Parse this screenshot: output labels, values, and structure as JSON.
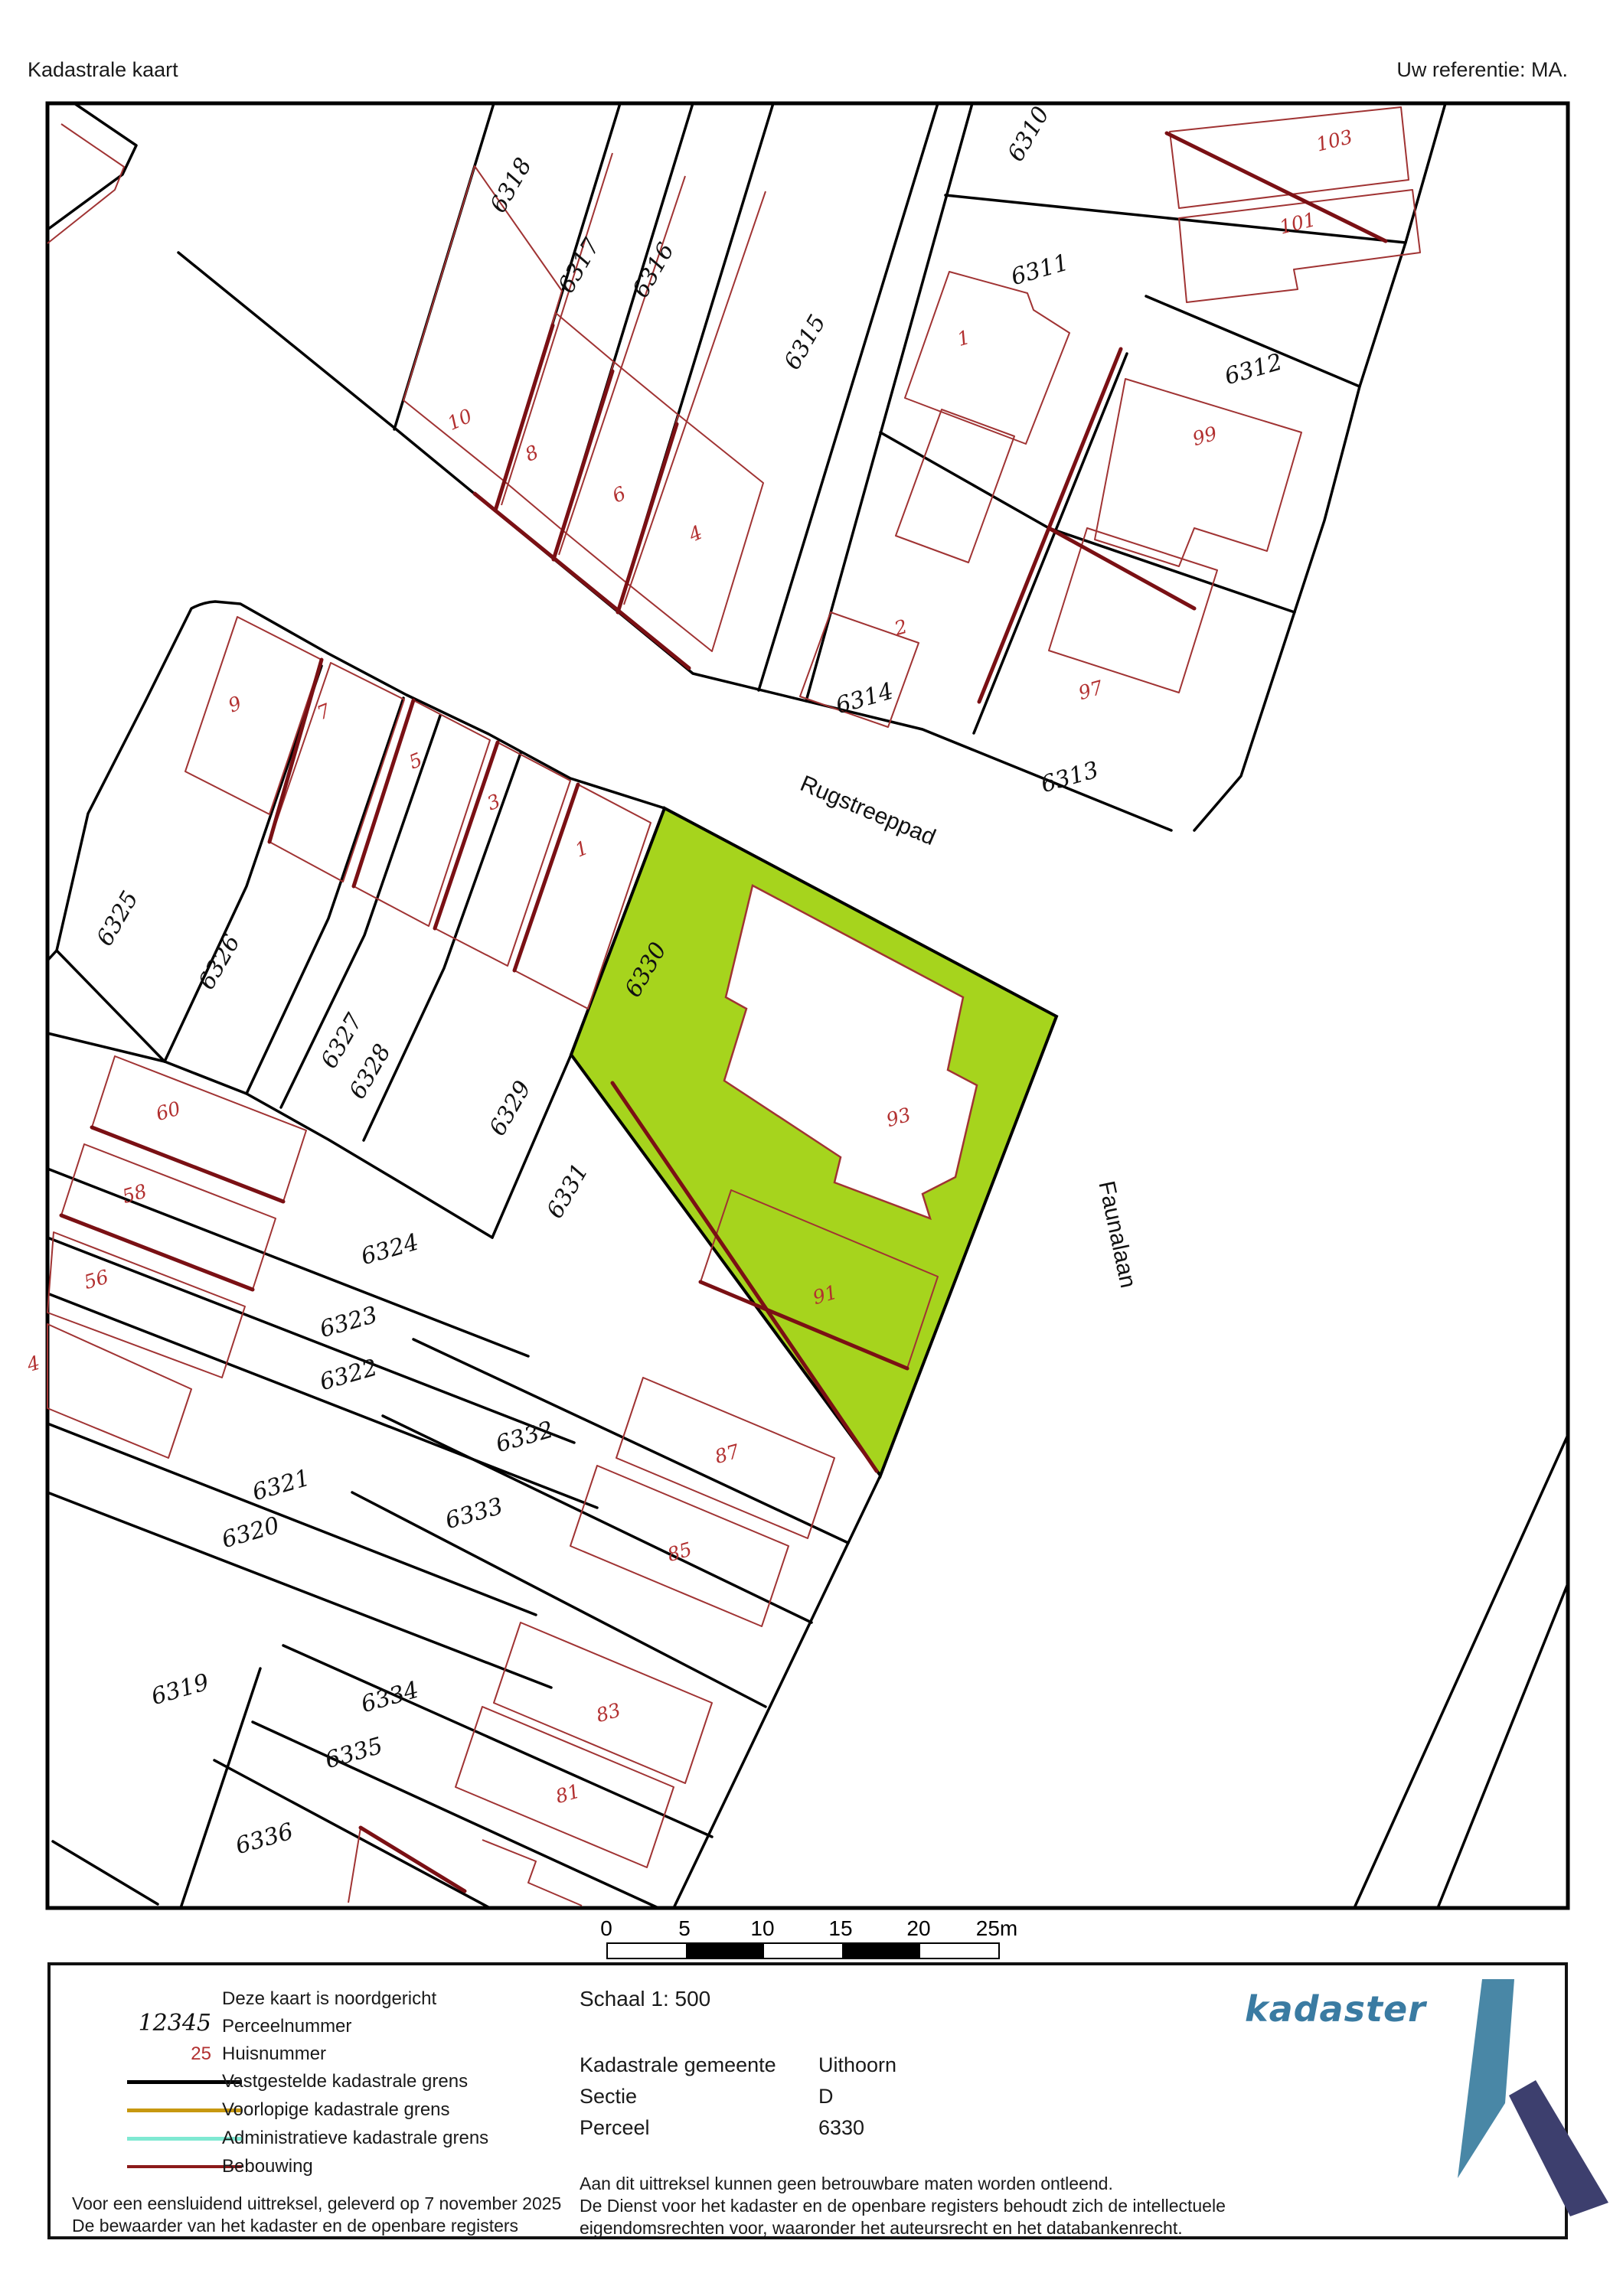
{
  "header": {
    "title": "Kadastrale kaart",
    "reference": "Uw referentie: MA."
  },
  "map": {
    "highlight_color": "#a6d41d",
    "boundary_color": "#000000",
    "building_color": "#a03333",
    "building_bold_color": "#7a1014",
    "street_labels": [
      {
        "text": "Rugstreeppad"
      },
      {
        "text": "Faunalaan"
      }
    ],
    "parcel_labels": [
      {
        "text": "6318"
      },
      {
        "text": "6317"
      },
      {
        "text": "6316"
      },
      {
        "text": "6315"
      },
      {
        "text": "6310"
      },
      {
        "text": "6311"
      },
      {
        "text": "6312"
      },
      {
        "text": "6314"
      },
      {
        "text": "6313"
      },
      {
        "text": "6325"
      },
      {
        "text": "6326"
      },
      {
        "text": "6327"
      },
      {
        "text": "6328"
      },
      {
        "text": "6329"
      },
      {
        "text": "6330"
      },
      {
        "text": "6331"
      },
      {
        "text": "6324"
      },
      {
        "text": "6323"
      },
      {
        "text": "6322"
      },
      {
        "text": "6321"
      },
      {
        "text": "6320"
      },
      {
        "text": "6319"
      },
      {
        "text": "6332"
      },
      {
        "text": "6333"
      },
      {
        "text": "6334"
      },
      {
        "text": "6335"
      },
      {
        "text": "6336"
      }
    ],
    "house_labels": [
      {
        "text": "103"
      },
      {
        "text": "101"
      },
      {
        "text": "99"
      },
      {
        "text": "97"
      },
      {
        "text": "1"
      },
      {
        "text": "2"
      },
      {
        "text": "10"
      },
      {
        "text": "8"
      },
      {
        "text": "6"
      },
      {
        "text": "4"
      },
      {
        "text": "9"
      },
      {
        "text": "7"
      },
      {
        "text": "5"
      },
      {
        "text": "3"
      },
      {
        "text": "1"
      },
      {
        "text": "93"
      },
      {
        "text": "91"
      },
      {
        "text": "87"
      },
      {
        "text": "85"
      },
      {
        "text": "83"
      },
      {
        "text": "81"
      },
      {
        "text": "60"
      },
      {
        "text": "58"
      },
      {
        "text": "56"
      },
      {
        "text": "4"
      }
    ]
  },
  "scale_bar": {
    "labels": [
      "0",
      "5",
      "10",
      "15",
      "20",
      "25m"
    ]
  },
  "legend": {
    "north_note": "Deze kaart is noordgericht",
    "parcel_number_sample": "12345",
    "parcel_number_label": "Perceelnummer",
    "house_number_sample": "25",
    "house_number_label": "Huisnummer",
    "lines": [
      {
        "label": "Vastgestelde kadastrale grens",
        "color": "#000000"
      },
      {
        "label": "Voorlopige kadastrale grens",
        "color": "#c79810"
      },
      {
        "label": "Administratieve kadastrale grens",
        "color": "#7fe9d2"
      },
      {
        "label": "Bebouwing",
        "color": "#8b1a1a"
      }
    ],
    "footer_line1": "Voor een eensluidend uittreksel, geleverd op 7 november 2025",
    "footer_line2": "De bewaarder van het kadaster en de openbare registers",
    "scale_label": "Schaal 1: 500",
    "details": [
      {
        "key": "Kadastrale gemeente",
        "value": "Uithoorn"
      },
      {
        "key": "Sectie",
        "value": "D"
      },
      {
        "key": "Perceel",
        "value": "6330"
      }
    ],
    "disclaimer1": "Aan dit uittreksel kunnen geen betrouwbare maten worden ontleend.",
    "disclaimer2": "De Dienst voor het kadaster en de openbare registers behoudt zich de intellectuele",
    "disclaimer3": "eigendomsrechten voor, waaronder het auteursrecht en het databankenrecht.",
    "logo_text": "kadaster"
  }
}
